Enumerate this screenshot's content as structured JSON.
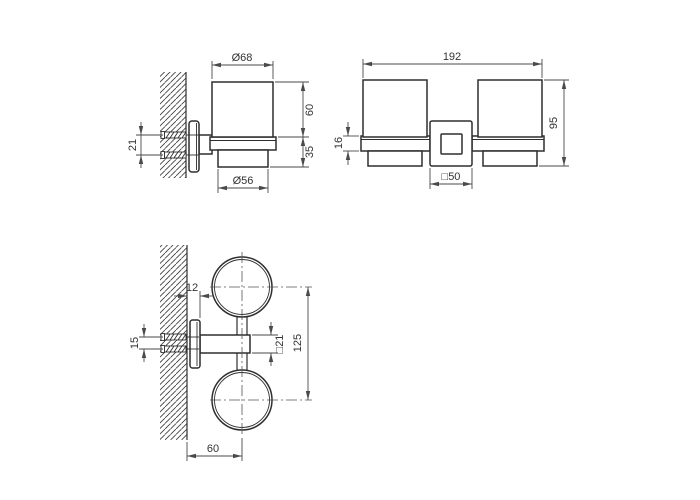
{
  "colors": {
    "background": "#ffffff",
    "object_line": "#2e2e2e",
    "dimension_line": "#4a4a4a",
    "text": "#333333"
  },
  "views": {
    "side": {
      "dims": {
        "cup_top_diameter": "Ø68",
        "cup_height": "60",
        "holder_height": "35",
        "cup_bottom_diameter": "Ø56",
        "screw_spacing": "21"
      }
    },
    "front": {
      "dims": {
        "overall_width": "192",
        "overall_height": "95",
        "ring_height": "16",
        "bracket_size": "□50"
      }
    },
    "plan": {
      "dims": {
        "plate_thickness": "12",
        "screw_spacing": "15",
        "bar_section": "□21",
        "cup_center_distance": "125",
        "wall_to_cup_center": "60"
      }
    }
  }
}
